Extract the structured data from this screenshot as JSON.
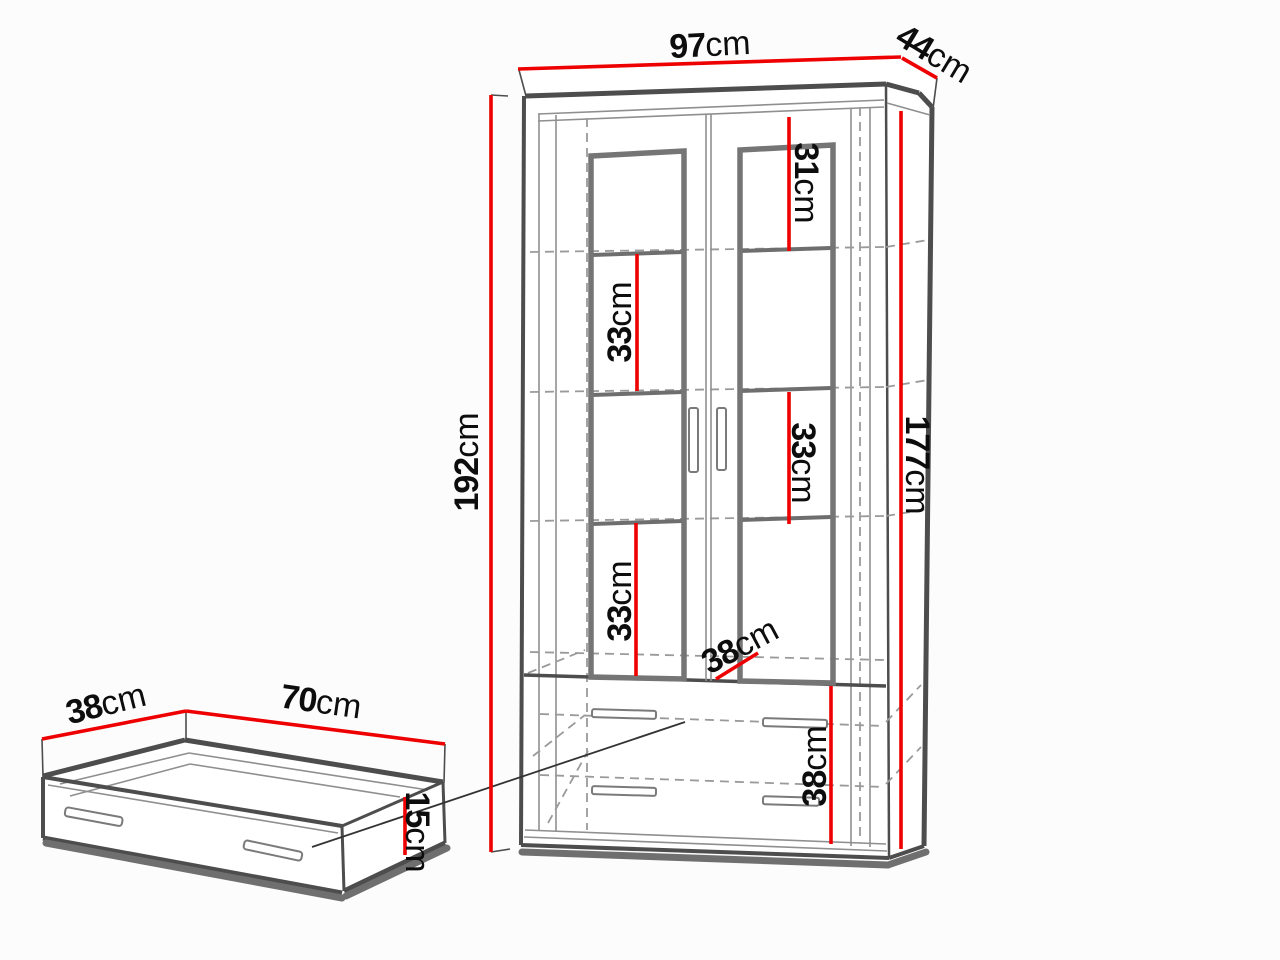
{
  "diagram_type": "furniture-dimension-diagram",
  "subject": "display cabinet with two glass doors, shelves and two drawers, plus separate underbed-style drawer box",
  "labels": {
    "cabinet_width": {
      "value": "97",
      "unit": "cm"
    },
    "cabinet_depth": {
      "value": "44",
      "unit": "cm"
    },
    "cabinet_height": {
      "value": "192",
      "unit": "cm"
    },
    "cabinet_front_height": {
      "value": "177",
      "unit": "cm"
    },
    "top_compartment_height": {
      "value": "31",
      "unit": "cm"
    },
    "compartment_left_upper": {
      "value": "33",
      "unit": "cm"
    },
    "compartment_right_middle": {
      "value": "33",
      "unit": "cm"
    },
    "compartment_left_lower": {
      "value": "33",
      "unit": "cm"
    },
    "interior_shelf_depth": {
      "value": "38",
      "unit": "cm"
    },
    "drawer_section_height": {
      "value": "38",
      "unit": "cm"
    },
    "drawer_box_depth": {
      "value": "38",
      "unit": "cm"
    },
    "drawer_box_width": {
      "value": "70",
      "unit": "cm"
    },
    "drawer_box_height": {
      "value": "15",
      "unit": "cm"
    }
  },
  "colors": {
    "dimension_line": "#ee0000",
    "text": "#0d0d0d",
    "background": "#fcfcfc"
  }
}
